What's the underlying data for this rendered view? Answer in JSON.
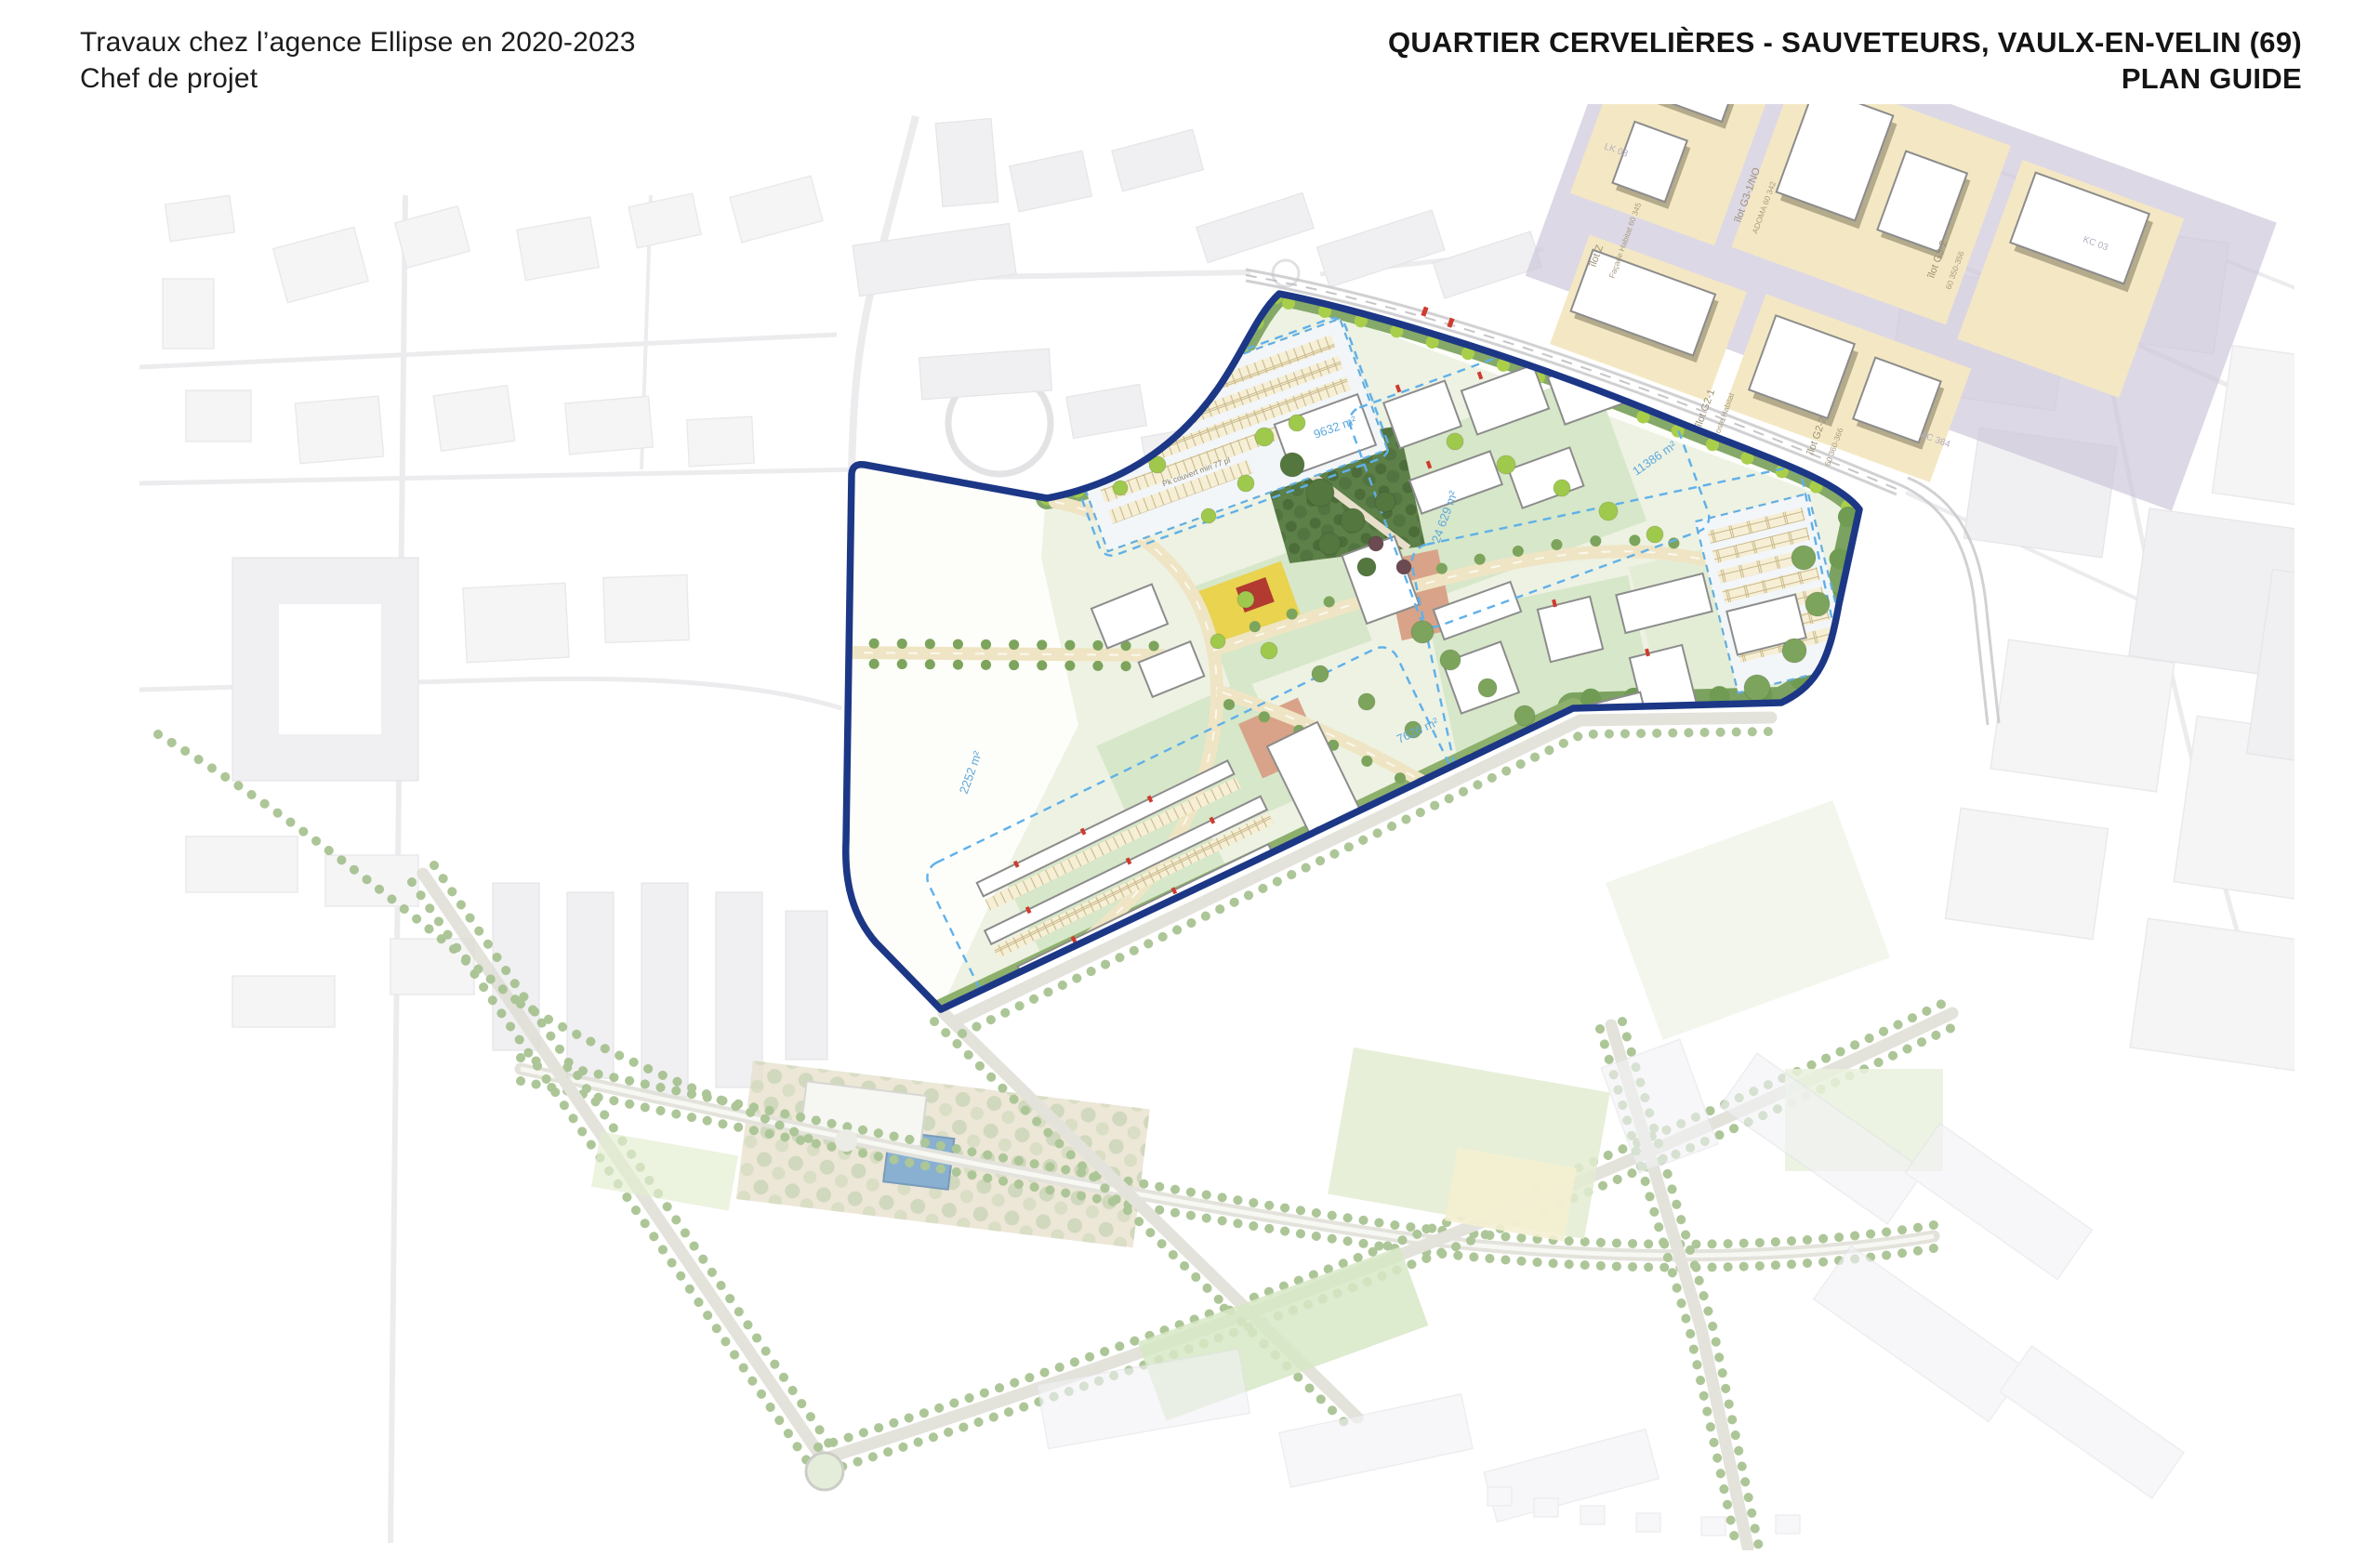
{
  "header": {
    "left": {
      "line1": "Travaux chez l’agence Ellipse en 2020-2023",
      "line2": "Chef de projet"
    },
    "right": {
      "line1": "QUARTIER CERVELIÈRES - SAUVETEURS, VAULX-EN-VELIN (69)",
      "line2": "PLAN GUIDE"
    }
  },
  "map": {
    "type": "urban masterplan (plan guide)",
    "colors": {
      "boundary_navy": "#1c3786",
      "plan_lawn_green": "#d7e7c9",
      "park_dark_green": "#5d8048",
      "tree_bright_green": "#9fc94c",
      "road_cream": "#efe5c4",
      "parcel_dash_blue": "#5fb0ea",
      "ilot_yellow": "#f4e8c4",
      "avenue_purple": "#cdc6d8",
      "plaza_terracotta": "#d8a388",
      "garden_yellow": "#e9d34f",
      "garden_red": "#b23a31",
      "pool_blue": "#6f9fc7",
      "context_grey": "#efeff2"
    },
    "ilot_labels": [
      {
        "text": "îlot Z"
      },
      {
        "text": "Façade Habitat 60 345"
      },
      {
        "text": "îlot G3-1/NO"
      },
      {
        "text": "ADOMA 60 342"
      },
      {
        "text": "îlot G3-2"
      },
      {
        "text": "60 350-356"
      },
      {
        "text": "îlot G2-1"
      },
      {
        "text": "Poste Habitat"
      },
      {
        "text": "îlot G2-2"
      },
      {
        "text": "60 360-366"
      }
    ],
    "area_labels": [
      {
        "text": "9632 m²"
      },
      {
        "text": "24 629 m²"
      },
      {
        "text": "11386 m²"
      },
      {
        "text": "7626 m²"
      },
      {
        "text": "5404 m²"
      },
      {
        "text": "2252 m²"
      }
    ],
    "parking_labels": [
      {
        "text": "Pk surface 44x27 m"
      },
      {
        "text": "Pk couvert min 77 pl"
      }
    ],
    "road_labels": [
      {
        "text": "LK 03"
      },
      {
        "text": "KC 03"
      },
      {
        "text": "AC 384"
      }
    ]
  }
}
